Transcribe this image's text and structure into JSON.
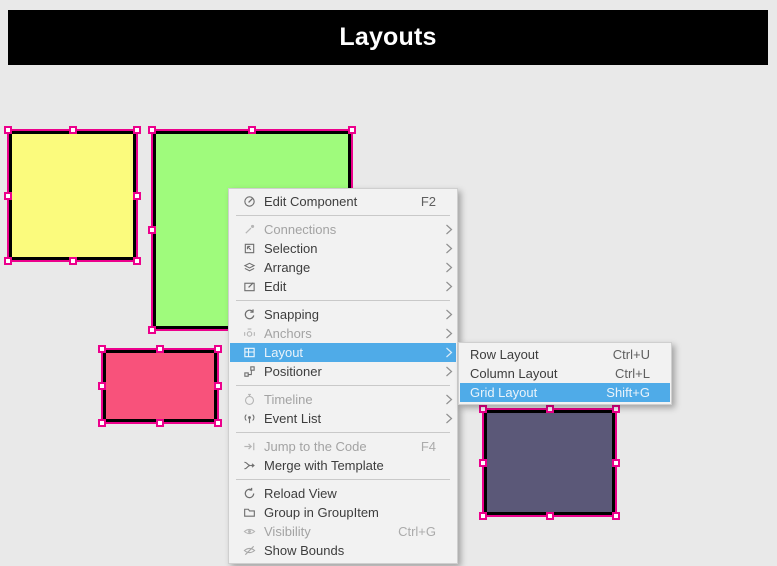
{
  "header": {
    "title": "Layouts"
  },
  "colors": {
    "header_bg": "#000000",
    "canvas_bg": "#e9e9e9",
    "selection": "#EC008C",
    "menu_highlight": "#4fabe8"
  },
  "canvas": {
    "rects": [
      {
        "name": "yellow-square",
        "fill": "#fbfb7d"
      },
      {
        "name": "green-square",
        "fill": "#9ffb7c"
      },
      {
        "name": "pink-rectangle",
        "fill": "#f8527b"
      },
      {
        "name": "purple-rectangle",
        "fill": "#5b5878"
      }
    ]
  },
  "context_menu": {
    "items": [
      {
        "label": "Edit Component",
        "shortcut": "F2"
      },
      {
        "type": "separator"
      },
      {
        "label": "Connections",
        "disabled": true,
        "submenu": true
      },
      {
        "label": "Selection",
        "submenu": true
      },
      {
        "label": "Arrange",
        "submenu": true
      },
      {
        "label": "Edit",
        "submenu": true
      },
      {
        "type": "separator"
      },
      {
        "label": "Snapping",
        "submenu": true
      },
      {
        "label": "Anchors",
        "disabled": true,
        "submenu": true
      },
      {
        "label": "Layout",
        "submenu": true,
        "highlighted": true
      },
      {
        "label": "Positioner",
        "submenu": true
      },
      {
        "type": "separator"
      },
      {
        "label": "Timeline",
        "disabled": true,
        "submenu": true
      },
      {
        "label": "Event List",
        "submenu": true
      },
      {
        "type": "separator"
      },
      {
        "label": "Jump to the Code",
        "shortcut": "F4",
        "disabled": true
      },
      {
        "label": "Merge with Template"
      },
      {
        "type": "separator"
      },
      {
        "label": "Reload View"
      },
      {
        "label": "Group in GroupItem"
      },
      {
        "label": "Visibility",
        "shortcut": "Ctrl+G",
        "disabled": true
      },
      {
        "label": "Show Bounds"
      }
    ]
  },
  "layout_submenu": {
    "items": [
      {
        "label": "Row Layout",
        "shortcut": "Ctrl+U"
      },
      {
        "label": "Column Layout",
        "shortcut": "Ctrl+L"
      },
      {
        "label": "Grid Layout",
        "shortcut": "Shift+G",
        "highlighted": true
      }
    ]
  }
}
